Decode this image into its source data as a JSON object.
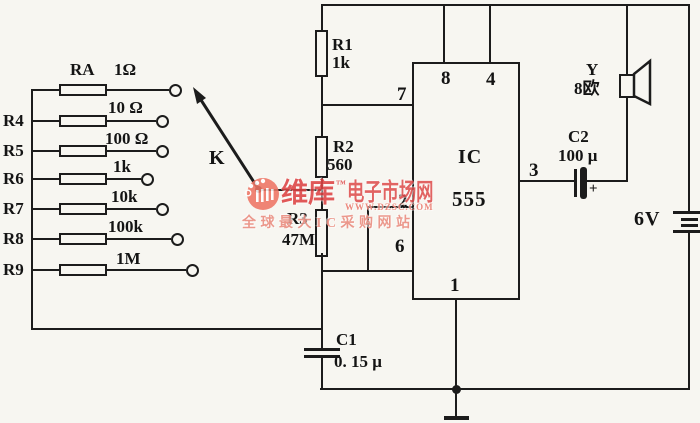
{
  "figure": {
    "type": "circuit-schematic",
    "description": "555 timer audio oscillator with selectable resistor bank and speaker output"
  },
  "colors": {
    "line": "#1c1c1c",
    "background": "#f7f6f1",
    "watermark_red": "#dd4343",
    "watermark_salmon": "#eb9184"
  },
  "ladder": {
    "switch_label": "K",
    "rows": [
      {
        "name": "RA",
        "value": "1Ω"
      },
      {
        "name": "R4",
        "value": "10 Ω"
      },
      {
        "name": "R5",
        "value": "100 Ω"
      },
      {
        "name": "R6",
        "value": "1k"
      },
      {
        "name": "R7",
        "value": "10k"
      },
      {
        "name": "R8",
        "value": "100k"
      },
      {
        "name": "R9",
        "value": "1M"
      }
    ]
  },
  "components": {
    "r1": {
      "name": "R1",
      "value": "1k"
    },
    "r2": {
      "name": "R2",
      "value": "560"
    },
    "r3": {
      "name": "R3",
      "value": "47M"
    },
    "c1": {
      "name": "C1",
      "value": "0. 15 μ"
    },
    "c2": {
      "name": "C2",
      "value": "100 μ",
      "polarity": "+"
    },
    "speaker": {
      "name": "Y",
      "value": "8欧"
    },
    "battery": {
      "value": "6V"
    },
    "ic": {
      "name": "IC",
      "value": "555"
    }
  },
  "ic_pins": {
    "p8": "8",
    "p4": "4",
    "p7": "7",
    "p2": "2",
    "p6": "6",
    "p3": "3",
    "p1": "1"
  },
  "watermark": {
    "brand": "维库",
    "tm": "™",
    "suffix": "电子市场网",
    "url": "WWW.DZSC.COM",
    "slogan": "全球最大IC采购网站"
  }
}
